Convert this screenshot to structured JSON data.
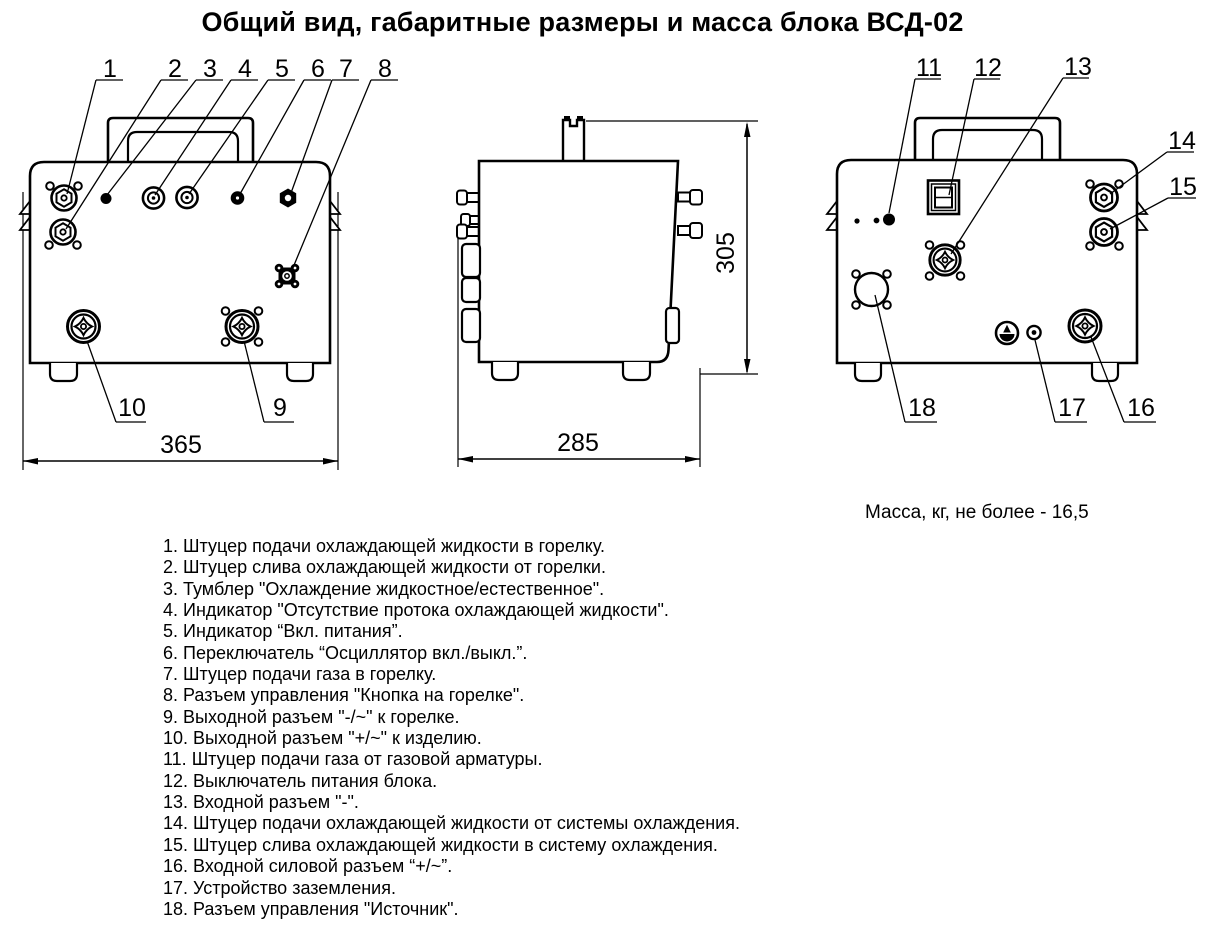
{
  "title": "Общий вид, габаритные размеры и масса блока ВСД-02",
  "dimensions": {
    "front_width": "365",
    "side_depth": "285",
    "side_height": "305"
  },
  "mass_note": "Масса, кг, не более - 16,5",
  "callouts": {
    "c1": "1",
    "c2": "2",
    "c3": "3",
    "c4": "4",
    "c5": "5",
    "c6": "6",
    "c7": "7",
    "c8": "8",
    "c9": "9",
    "c10": "10",
    "c11": "11",
    "c12": "12",
    "c13": "13",
    "c14": "14",
    "c15": "15",
    "c16": "16",
    "c17": "17",
    "c18": "18"
  },
  "legend": {
    "items": [
      "1. Штуцер подачи охлаждающей жидкости в горелку.",
      "2. Штуцер слива охлаждающей жидкости от горелки.",
      "3. Тумблер \"Охлаждение жидкостное/естественное\".",
      "4. Индикатор \"Отсутствие протока охлаждающей жидкости\".",
      "5. Индикатор “Вкл. питания”.",
      "6. Переключатель “Осциллятор вкл./выкл.”.",
      "7. Штуцер подачи газа в горелку.",
      "8. Разъем управления \"Кнопка на горелке\".",
      "9. Выходной разъем \"-/~\" к горелке.",
      "10. Выходной разъем \"+/~\" к изделию.",
      "11. Штуцер подачи газа от газовой арматуры.",
      "12. Выключатель питания блока.",
      "13. Входной разъем \"-\".",
      "14. Штуцер подачи охлаждающей жидкости от системы охлаждения.",
      "15. Штуцер слива охлаждающей жидкости в систему охлаждения.",
      "16. Входной силовой разъем “+/~”.",
      "17. Устройство заземления.",
      "18. Разъем управления \"Источник\"."
    ]
  }
}
